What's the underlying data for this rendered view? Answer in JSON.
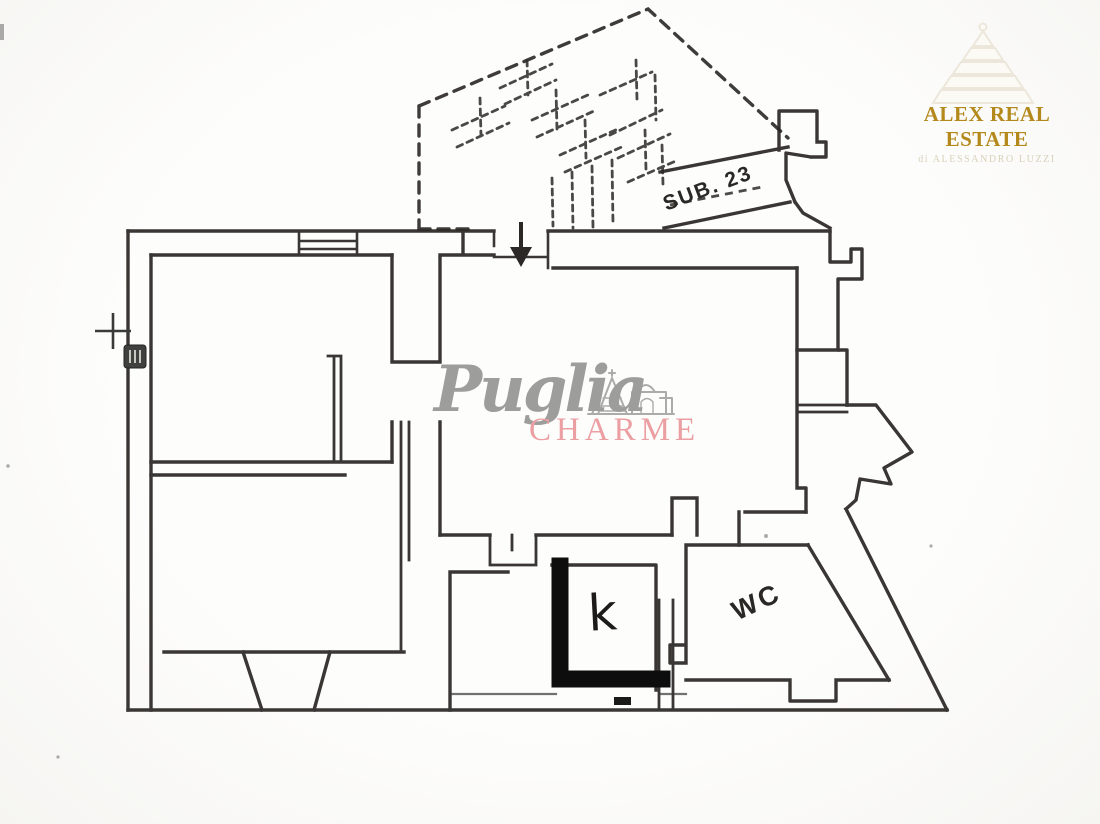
{
  "page": {
    "background": "#fcfcfa",
    "ink_color": "#2b2825"
  },
  "plan": {
    "labels": {
      "sub": "SUB. 23",
      "wc": "WC",
      "kitchen": "k"
    },
    "marker_color": "#0d0d0d"
  },
  "watermark": {
    "word1": "Puglia",
    "word2": "CHARME",
    "word1_color": "#9d9d9c",
    "word2_color": "#ec9fa2",
    "trulli_icon": "trulli-skyline-sketch"
  },
  "logo": {
    "title": "ALEX REAL ESTATE",
    "subtitle": "di ALESSANDRO LUZZI",
    "title_color": "#b3891c",
    "subtitle_color": "#d8d0ba",
    "cone_icon": "trullo-cone"
  }
}
